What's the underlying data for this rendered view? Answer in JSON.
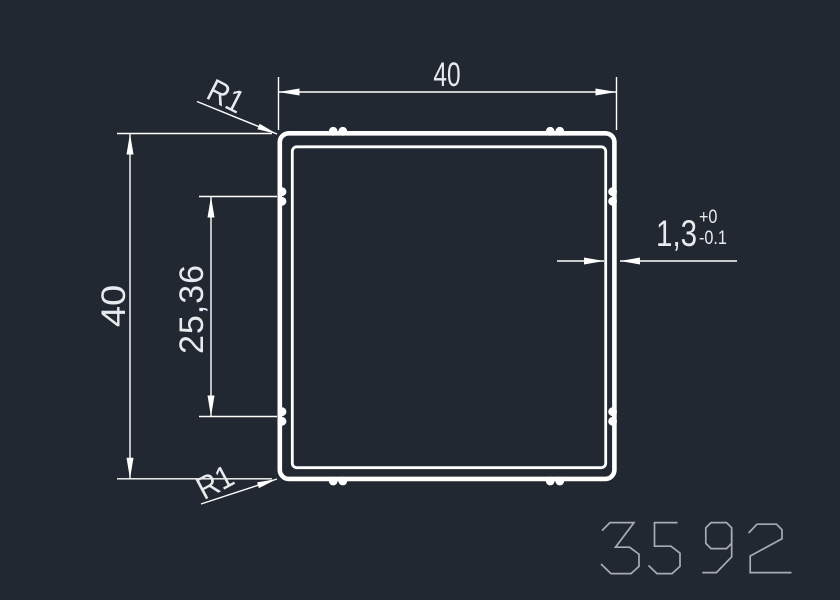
{
  "drawing": {
    "title": "square tube profile cross-section",
    "dim_width": {
      "label": "40"
    },
    "dim_height": {
      "label": "40"
    },
    "dim_groove_spacing": {
      "label": "25,36"
    },
    "dim_wall": {
      "label": "1,3",
      "tolerance_upper": "+0",
      "tolerance_lower": "-0.1"
    },
    "radius_top_left": {
      "label": "R1"
    },
    "radius_bottom_left": {
      "label": "R1"
    },
    "part_number": "3592"
  },
  "colors": {
    "background": "#222831",
    "line": "#ffffff",
    "dim_text": "#e8ebed",
    "part_number_stroke": "#a7acb4"
  }
}
